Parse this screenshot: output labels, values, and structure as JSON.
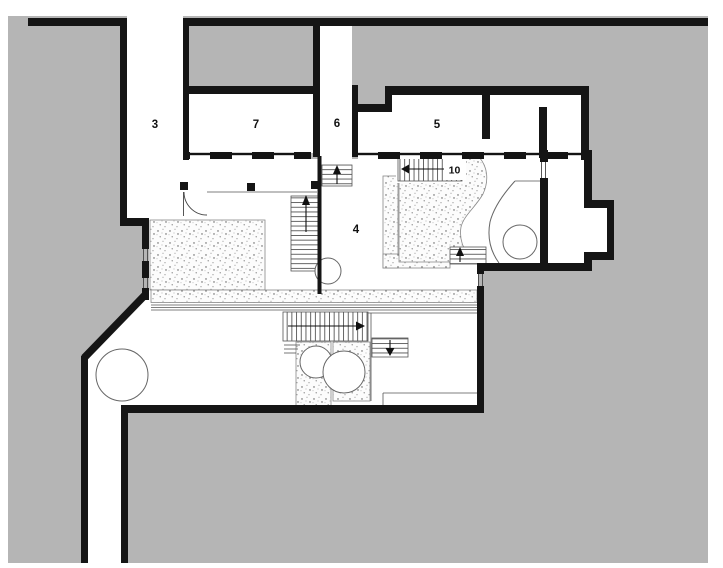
{
  "plan": {
    "labels": {
      "room3": "3",
      "room7": "7",
      "room6": "6",
      "room5": "5",
      "room4": "4",
      "stair10": "10"
    }
  },
  "colors": {
    "background": "#b5b5b5",
    "wall": "#151515",
    "paper": "#ffffff"
  }
}
